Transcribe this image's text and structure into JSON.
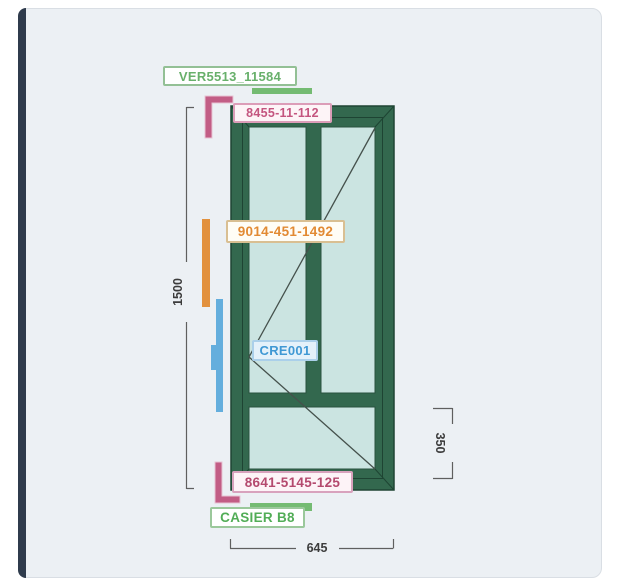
{
  "diagram": {
    "title": "window-fabrication-drawing",
    "tags": {
      "ver": {
        "text": "VER5513_11584",
        "color": "#68b06b"
      },
      "top_profile": {
        "text": "8455-11-112",
        "color": "#c4557f"
      },
      "left_profile": {
        "text": "9014-451-1492",
        "color": "#e28a33"
      },
      "cremone": {
        "text": "CRE001",
        "color": "#3f98d4"
      },
      "bottom_profile": {
        "text": "8641-5145-125",
        "color": "#b4496e"
      },
      "casier": {
        "text": "CASIER B8",
        "color": "#52ad57"
      }
    },
    "dimensions": {
      "total_height": "1500",
      "total_width": "645",
      "bottom_section_height": "350"
    },
    "colors": {
      "frame": "#33684e",
      "frame_outline": "#1e4433",
      "glass": "#cbe4e1",
      "opening_line": "#45514c",
      "accent_green": "#74bb72",
      "accent_pink": "#c25d85",
      "accent_orange": "#e2913e",
      "accent_blue": "#64aedd",
      "dimension_line": "#5f5f5f",
      "canvas_bg": "#ecf0f4",
      "left_strip": "#2f3b4c"
    }
  }
}
